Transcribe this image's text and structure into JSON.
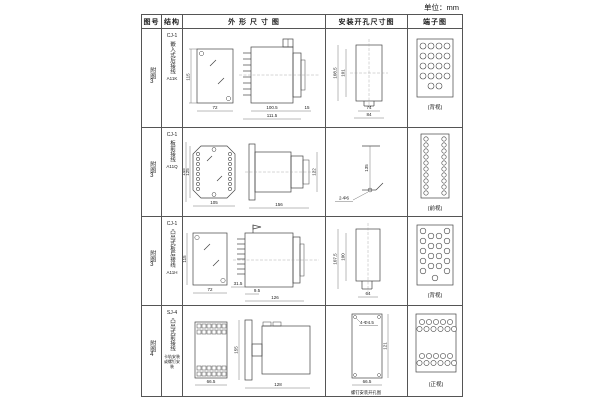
{
  "page": {
    "unit_label": "单位：mm"
  },
  "table": {
    "headers": {
      "fig": "图号",
      "struct": "结构",
      "outline": "外 形 尺 寸 图",
      "mount": "安装开孔尺寸图",
      "terminal": "端子图"
    },
    "rows": [
      {
        "fig_no": "附图3",
        "model": "CJ-1",
        "structure": "嵌入式后接线",
        "code": "A11K",
        "note": "",
        "outline": {
          "front_h": "115",
          "front_w": "72",
          "body_w": "100.5",
          "overall_w": "111.5",
          "flange_w": "15"
        },
        "mount": {
          "v1": "108.5",
          "v2": "101",
          "h1": "74",
          "h2": "84"
        },
        "terminal_label": "(背视)"
      },
      {
        "fig_no": "附图3",
        "model": "CJ-1",
        "structure": "板前接线",
        "code": "A11Q",
        "note": "",
        "outline": {
          "front_h": "145",
          "front_h2": "125",
          "front_w": "105",
          "side_w": "156",
          "side_h": "122"
        },
        "mount": {
          "v1": "135",
          "hole": "2-Φ6"
        },
        "terminal_label": "(前视)"
      },
      {
        "fig_no": "附图3",
        "model": "CJ-1",
        "structure": "凸出式板后接线",
        "code": "A11H",
        "note": "",
        "outline": {
          "front_h": "115",
          "front_w": "72",
          "pin_w": "31.5",
          "gap": "9.5",
          "overall_w": "126"
        },
        "mount": {
          "v1": "107.5",
          "v2": "100",
          "h1": "64"
        },
        "terminal_label": "(背视)"
      },
      {
        "fig_no": "附图4",
        "model": "SJ-4",
        "structure": "凸出式前接线",
        "code": "",
        "note": "卡轨安装或螺钉安装",
        "outline": {
          "front_w": "66.5",
          "side_h": "155",
          "side_w": "128"
        },
        "mount": {
          "hole": "4-Φ4.5",
          "v1": "121",
          "h1": "66.5",
          "caption": "螺钉安装开孔图"
        },
        "terminal_label": "(正视)"
      }
    ]
  }
}
